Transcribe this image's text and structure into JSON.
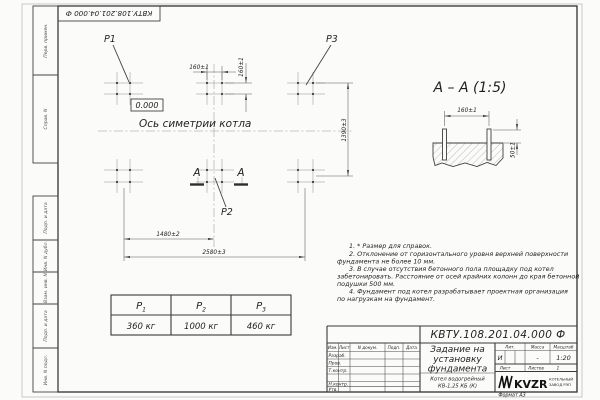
{
  "sheet": {
    "top_doc_number": "КВТУ.108.201.04.000  Ф",
    "format_note": "Формат А3"
  },
  "margin_labels": {
    "perv_primen": "Перв. примен.",
    "sprav_n": "Справ. N",
    "podp_data_1": "Подп. и дата",
    "inv_dubl": "Инв. N дубл.",
    "vzam_inv": "Взам. инв. N",
    "podp_data_2": "Подп. и дата",
    "inv_podl": "Инв. N подл."
  },
  "plan": {
    "label_p1": "P1",
    "label_p2": "P2",
    "label_p3": "P3",
    "level_mark": "0.000",
    "axis_label": "Ось симетрии котла",
    "section_letter_left": "А",
    "section_letter_right": "А",
    "dim_pitch_x": "160±1",
    "dim_pitch_y": "160±1",
    "dim_height": "1390±3",
    "dim_half": "1480±2",
    "dim_total": "2580±3"
  },
  "section_view": {
    "title": "А – А (1:5)",
    "dim_pitch": "160±1",
    "dim_protrusion": "50±1"
  },
  "notes": [
    "1. * Размер для справок.",
    "2. Отклонение от горизонтального уровня верхней поверхности",
    "фундамента не более 10 мм.",
    "3. В случае отсутствия бетонного пола площадку под котел",
    "забетонировать. Расстояние от осей крайних колонн до края бетонной",
    "подушки 500 мм.",
    "4. Фундамент под котел разрабатывает проектная организация",
    "по нагрузкам на фундамент."
  ],
  "load_table": {
    "headers": [
      {
        "base": "P",
        "sub": "1"
      },
      {
        "base": "P",
        "sub": "2"
      },
      {
        "base": "P",
        "sub": "3"
      }
    ],
    "values": [
      "360 кг",
      "1000 кг",
      "460 кг"
    ]
  },
  "title_block": {
    "doc_number": "КВТУ.108.201.04.000  Ф",
    "title_line1": "Задание на",
    "title_line2": "установку",
    "title_line3": "фундамента",
    "product_line1": "Котел водогрейный",
    "product_line2": "КВ-1,25 КБ (К)",
    "col_izm": "Изм.",
    "col_list": "Лист",
    "col_ndoc": "N докум.",
    "col_podp": "Подп.",
    "col_data": "Дата",
    "row_razrab": "Разраб.",
    "row_prov": "Пров.",
    "row_tkontr": "Т.контр.",
    "row_nkontr": "Н.контр.",
    "row_utv": "Утв.",
    "lit_label": "Лит.",
    "lit_value": "И",
    "mass_label": "Масса",
    "mass_value": "-",
    "scale_label": "Масштаб",
    "scale_value": "1:20",
    "list_label": "Лист",
    "listov_label": "Листов",
    "listov_value": "1",
    "brand": "KVZR",
    "brand_sub1": "КОТЕЛЬНЫЙ",
    "brand_sub2": "ЗАВОД РЭП"
  }
}
